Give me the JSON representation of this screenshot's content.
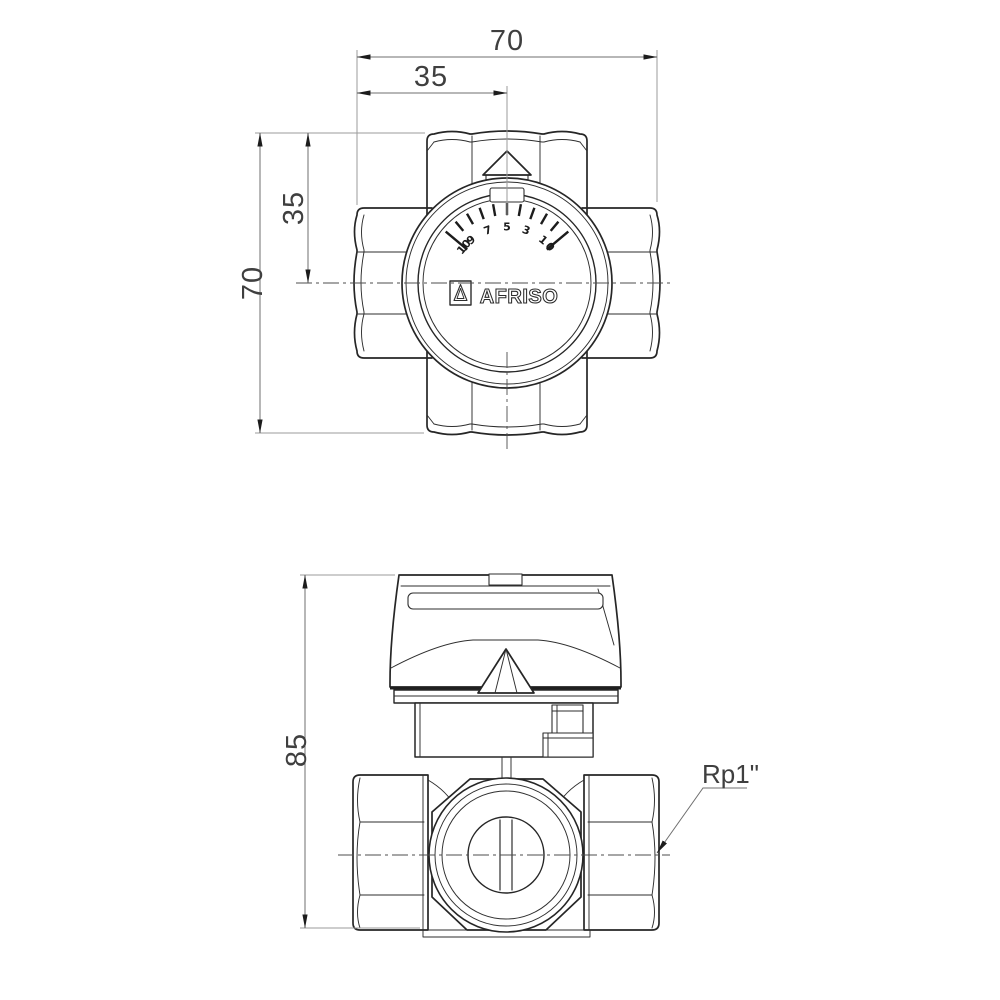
{
  "document": {
    "type": "technical-drawing",
    "background": "#ffffff",
    "line_color": "#262626",
    "dim_line_color": "#6f6f6f",
    "dim_text_color": "#3f3f3f"
  },
  "top_view": {
    "dims": {
      "width_total": "70",
      "width_center": "35",
      "height_center": "35",
      "height_total": "70"
    },
    "dial": {
      "brand": "AFRISO",
      "min": 0,
      "max": 10,
      "start_angle_deg": 40,
      "step_deg": 10,
      "labels": [
        "10",
        "9",
        "7",
        "5",
        "3",
        "1",
        "0"
      ],
      "label_units": [
        10,
        9,
        7,
        5,
        3,
        1,
        0
      ]
    }
  },
  "front_view": {
    "dims": {
      "height_total": "85"
    },
    "annotations": {
      "port_thread": "Rp1\""
    }
  }
}
